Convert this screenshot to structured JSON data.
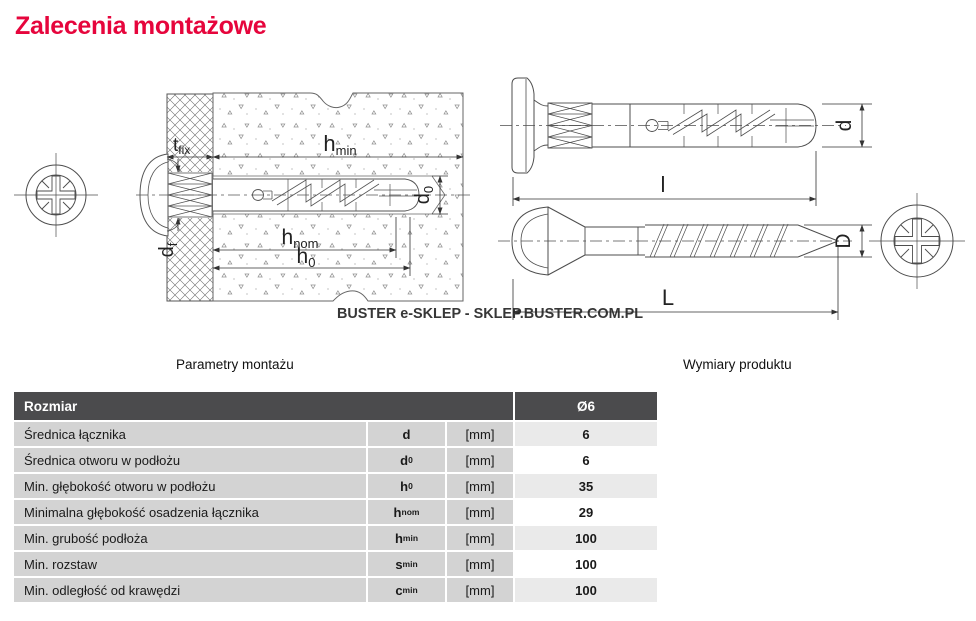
{
  "page": {
    "title": "Zalecenia montażowe"
  },
  "colors": {
    "accent_red": "#e6053c",
    "table_header_bg": "#4b4b4d",
    "table_cell_bg": "#d3d3d3",
    "table_value_alt_bg": "#eaeaea",
    "watermark_gray": "#9c9c9c"
  },
  "watermark": "BUSTER e-SKLEP - SKLEP.BUSTER.COM.PL",
  "sections": {
    "left_title": "Parametry montażu",
    "right_title": "Wymiary produktu"
  },
  "diagram": {
    "dims": {
      "tfix": {
        "base": "t",
        "sub": "fix"
      },
      "hmin": {
        "base": "h",
        "sub": "min"
      },
      "d0": {
        "base": "d",
        "sub": "0"
      },
      "hnom": {
        "base": "h",
        "sub": "nom"
      },
      "h0": {
        "base": "h",
        "sub": "0"
      },
      "df": {
        "base": "d",
        "sub": "f"
      },
      "d_plug": "d",
      "l_plug": "l",
      "D_screw": "D",
      "L_screw": "L"
    }
  },
  "table": {
    "header": {
      "label": "Rozmiar",
      "size": "Ø6"
    },
    "rows": [
      {
        "label": "Średnica łącznika",
        "symbol": {
          "base": "d",
          "sub": ""
        },
        "unit": "[mm]",
        "value": "6"
      },
      {
        "label": "Średnica otworu w podłożu",
        "symbol": {
          "base": "d",
          "sub": "0"
        },
        "unit": "[mm]",
        "value": "6"
      },
      {
        "label": "Min. głębokość otworu w podłożu",
        "symbol": {
          "base": "h",
          "sub": "0"
        },
        "unit": "[mm]",
        "value": "35"
      },
      {
        "label": "Minimalna głębokość osadzenia łącznika",
        "symbol": {
          "base": "h",
          "sub": "nom"
        },
        "unit": "[mm]",
        "value": "29"
      },
      {
        "label": "Min. grubość podłoża",
        "symbol": {
          "base": "h",
          "sub": "min"
        },
        "unit": "[mm]",
        "value": "100"
      },
      {
        "label": "Min. rozstaw",
        "symbol": {
          "base": "s",
          "sub": "min"
        },
        "unit": "[mm]",
        "value": "100"
      },
      {
        "label": "Min. odległość od krawędzi",
        "symbol": {
          "base": "c",
          "sub": "min"
        },
        "unit": "[mm]",
        "value": "100"
      }
    ]
  }
}
